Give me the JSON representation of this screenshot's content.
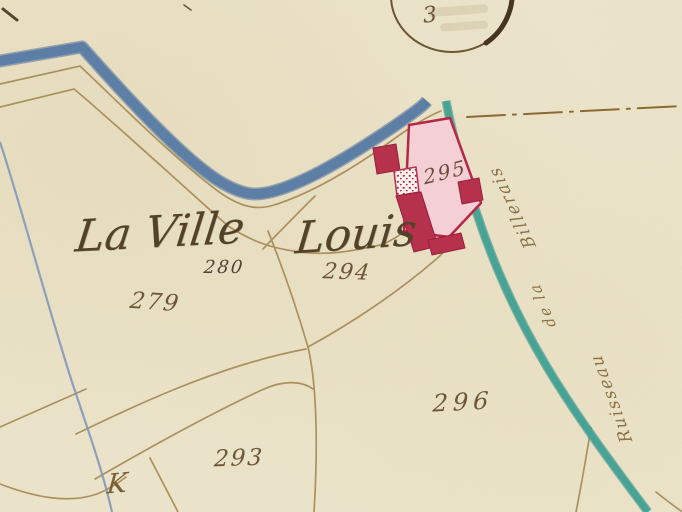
{
  "map": {
    "place_name": "La Ville Louis",
    "place_name_parts": {
      "left": "La Ville",
      "right": "Louis"
    },
    "parcel_numbers": {
      "p279": "279",
      "p280": "280",
      "p293": "293",
      "p294": "294",
      "p295": "295",
      "p296": "296"
    },
    "road_label": {
      "full": "Ruisseau de la Billerais",
      "top_segment": "Billerais",
      "middle_segment": "de la",
      "bottom_segment": "Ruisseau"
    },
    "section_mark": "3",
    "corner_mark": "K",
    "colors": {
      "parchment": "#ece5cb",
      "river_blue": "#5d7fa6",
      "stream_teal": "#46a396",
      "building_red": "#b6314b",
      "courtyard_pink": "#f4cfd6",
      "line_brown": "#a98c58",
      "ink_brown": "#52422a"
    }
  }
}
